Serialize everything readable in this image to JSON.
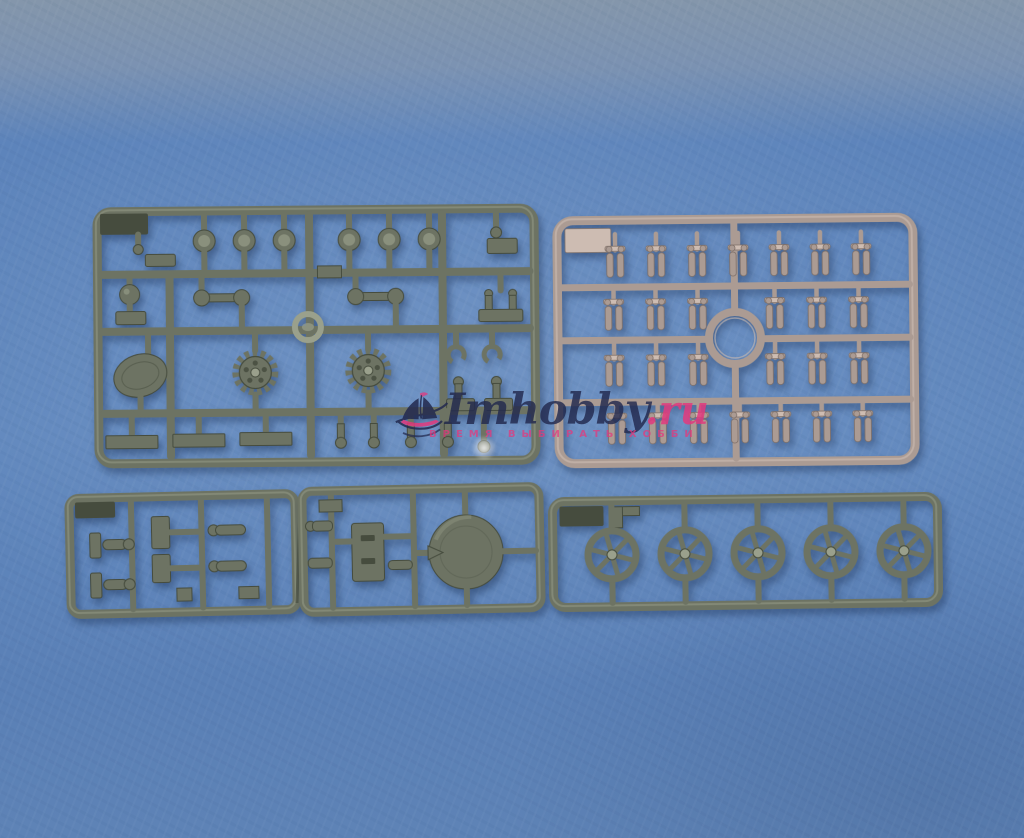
{
  "meta": {
    "type": "photograph",
    "subject": "Four plastic scale-model kit sprues (three olive green, one tan) laid on a blue textured paper background",
    "sprue_count": 4
  },
  "colors": {
    "background": "#5d84bb",
    "background_top": "#8496ab",
    "olive_base": "#6d7363",
    "olive_light": "#9aa08c",
    "olive_dark": "#464c3e",
    "tan_base": "#ab9b93",
    "tan_light": "#cdbcb2",
    "tan_dark": "#7e6f68",
    "watermark_navy": "#22294e",
    "watermark_pink": "#e23a7e"
  },
  "watermark": {
    "brand": "Imhobby",
    "domain": ".ru",
    "tagline": "ВРЕМЯ ВЫБИРАТЬ ХОББИ",
    "logo": "sailing-ship"
  },
  "sprues": {
    "top_left": {
      "label": "olive detail sprue with drive sprockets",
      "material_color_hex": "#6d7363",
      "parts": {
        "dome_ports": 6,
        "drive_sprockets": 2,
        "tow_hooks": 2,
        "ball_knob": 1,
        "teardrop_cover": 1,
        "ring": 1,
        "flat_plates": 3,
        "capped_pins": 4
      }
    },
    "top_right": {
      "label": "tan sprue with small paired parts and central ring",
      "material_color_hex": "#ab9b93",
      "cluster_rows": [
        7,
        6,
        6,
        7
      ],
      "total_clusters": 26,
      "center_ring": 1
    },
    "bottom_left": {
      "label": "olive small-parts sprue cut into two sections",
      "material_color_hex": "#6d7363",
      "sections": 2,
      "parts": {
        "slotted_panel": 1,
        "round_hatch": 1,
        "pins": 6,
        "brackets": 4
      }
    },
    "bottom_right": {
      "label": "olive sprue with spoked wheels",
      "material_color_hex": "#6d7363",
      "wheel_count": 5,
      "spokes_per_wheel": 6
    }
  }
}
